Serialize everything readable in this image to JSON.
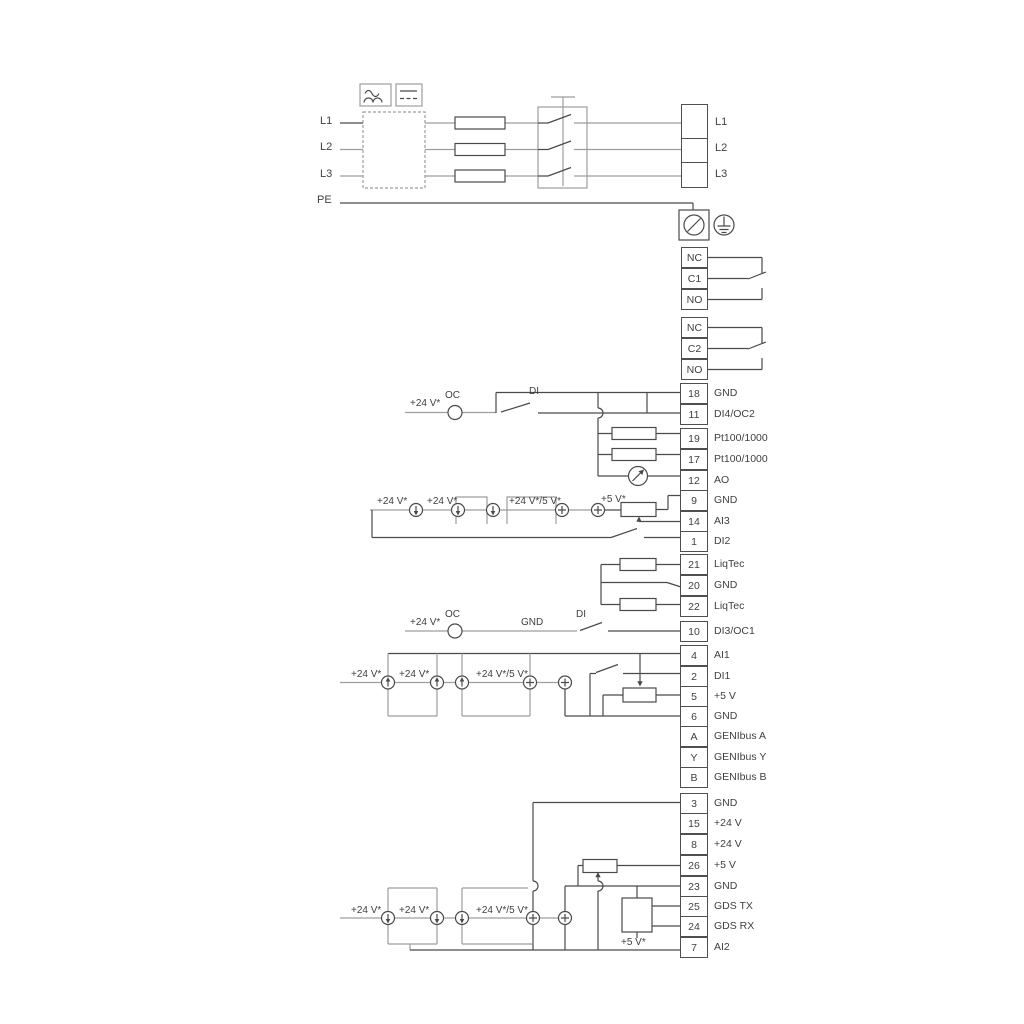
{
  "pw": {
    "in": [
      "L1",
      "L2",
      "L3",
      "PE"
    ],
    "out": [
      "L1",
      "L2",
      "L3"
    ]
  },
  "re": [
    [
      "NC",
      "C1",
      "NO"
    ],
    [
      "NC",
      "C2",
      "NO"
    ]
  ],
  "s1": [
    [
      "18",
      "GND"
    ],
    [
      "11",
      "DI4/OC2"
    ],
    [
      "19",
      "Pt100/1000"
    ],
    [
      "17",
      "Pt100/1000"
    ],
    [
      "12",
      "AO"
    ],
    [
      "9",
      "GND"
    ],
    [
      "14",
      "AI3"
    ],
    [
      "1",
      "DI2"
    ]
  ],
  "s2": [
    [
      "21",
      "LiqTec"
    ],
    [
      "20",
      "GND"
    ],
    [
      "22",
      "LiqTec"
    ]
  ],
  "s3": [
    [
      "10",
      "DI3/OC1"
    ]
  ],
  "s4": [
    [
      "4",
      "AI1"
    ],
    [
      "2",
      "DI1"
    ],
    [
      "5",
      "+5 V"
    ],
    [
      "6",
      "GND"
    ],
    [
      "A",
      "GENIbus A"
    ],
    [
      "Y",
      "GENIbus Y"
    ],
    [
      "B",
      "GENIbus B"
    ]
  ],
  "s5": [
    [
      "3",
      "GND"
    ],
    [
      "15",
      "+24 V"
    ],
    [
      "8",
      "+24 V"
    ],
    [
      "26",
      "+5 V"
    ],
    [
      "23",
      "GND"
    ],
    [
      "25",
      "GDS TX"
    ],
    [
      "24",
      "GDS RX"
    ],
    [
      "7",
      "AI2"
    ]
  ],
  "an": {
    "v24": "+24 V*",
    "v245": "+24 V*/5 V*",
    "v5": "+5 V*",
    "oc": "OC",
    "di": "DI",
    "gnd": "GND"
  },
  "colors": {
    "line_dark": "#4a4a4a",
    "line_gray": "#9e9e9e",
    "text": "#3f3f3f"
  }
}
